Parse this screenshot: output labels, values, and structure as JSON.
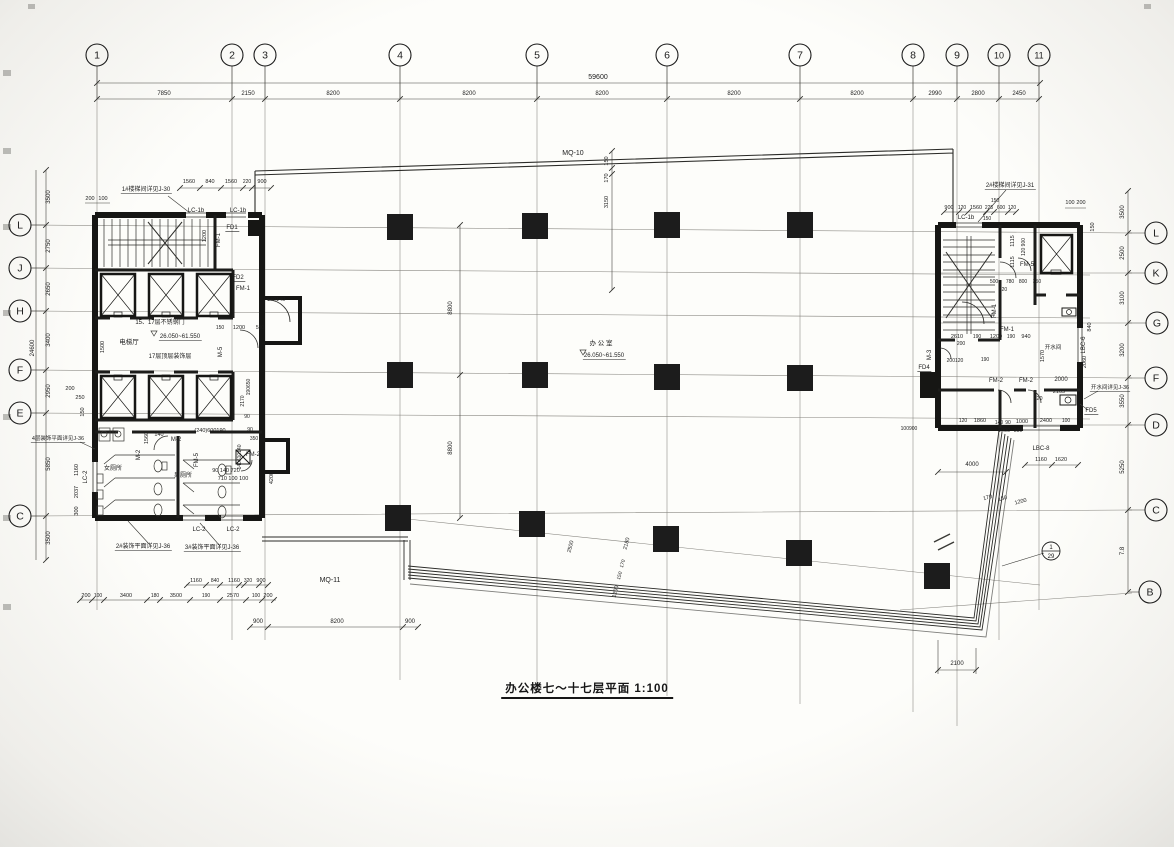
{
  "title": {
    "text": "办公楼七～十七层平面 1:100"
  },
  "colors": {
    "ink": "#1c1c1c",
    "paper": "#f6f6f2",
    "thin": "#6a6a66",
    "dim": "#3a3a38"
  },
  "grid_bubbles": {
    "top": [
      {
        "label": "1",
        "x": 97
      },
      {
        "label": "2",
        "x": 232
      },
      {
        "label": "3",
        "x": 265
      },
      {
        "label": "4",
        "x": 400
      },
      {
        "label": "5",
        "x": 537
      },
      {
        "label": "6",
        "x": 667
      },
      {
        "label": "7",
        "x": 800
      },
      {
        "label": "8",
        "x": 913
      },
      {
        "label": "9",
        "x": 957
      },
      {
        "label": "10",
        "x": 999
      },
      {
        "label": "11",
        "x": 1039
      }
    ],
    "left": [
      {
        "label": "L",
        "y": 225
      },
      {
        "label": "J",
        "y": 268
      },
      {
        "label": "H",
        "y": 311
      },
      {
        "label": "F",
        "y": 370
      },
      {
        "label": "E",
        "y": 413
      },
      {
        "label": "C",
        "y": 516
      }
    ],
    "right": [
      {
        "label": "L",
        "y": 233,
        "x": 1156
      },
      {
        "label": "K",
        "y": 273,
        "x": 1156
      },
      {
        "label": "G",
        "y": 323,
        "x": 1157
      },
      {
        "label": "F",
        "y": 378,
        "x": 1156
      },
      {
        "label": "D",
        "y": 425,
        "x": 1156
      },
      {
        "label": "C",
        "y": 510,
        "x": 1156
      },
      {
        "label": "B",
        "y": 592,
        "x": 1150
      }
    ]
  },
  "detail_bubble": {
    "x": 1051,
    "y": 551,
    "top": "1",
    "bottom": "29"
  },
  "columns": [
    [
      400,
      227
    ],
    [
      535,
      226
    ],
    [
      667,
      225
    ],
    [
      800,
      225
    ],
    [
      400,
      375
    ],
    [
      535,
      375
    ],
    [
      667,
      377
    ],
    [
      800,
      378
    ],
    [
      398,
      518
    ],
    [
      532,
      524
    ],
    [
      666,
      539
    ],
    [
      799,
      553
    ],
    [
      937,
      576
    ]
  ],
  "annotations": [
    [
      "59600",
      598,
      79,
      0,
      7,
      0
    ],
    [
      "7850",
      164,
      95,
      0,
      6,
      0
    ],
    [
      "2150",
      248,
      95,
      0,
      6,
      0
    ],
    [
      "8200",
      333,
      95,
      0,
      6,
      0
    ],
    [
      "8200",
      469,
      95,
      0,
      6,
      0
    ],
    [
      "8200",
      602,
      95,
      0,
      6,
      0
    ],
    [
      "8200",
      734,
      95,
      0,
      6,
      0
    ],
    [
      "8200",
      857,
      95,
      0,
      6,
      0
    ],
    [
      "2990",
      935,
      95,
      0,
      6,
      0
    ],
    [
      "2800",
      978,
      95,
      0,
      6,
      0
    ],
    [
      "2450",
      1019,
      95,
      0,
      6,
      0
    ],
    [
      "MQ-10",
      573,
      155,
      0,
      7,
      0
    ],
    [
      "150",
      608,
      161,
      -90,
      5.5,
      0
    ],
    [
      "170",
      608,
      178,
      -90,
      5.5,
      0
    ],
    [
      "3150",
      608,
      202,
      -90,
      5.5,
      0
    ],
    [
      "3500",
      50,
      197,
      -90,
      6,
      0
    ],
    [
      "2750",
      50,
      246,
      -90,
      6,
      0
    ],
    [
      "2650",
      50,
      289,
      -90,
      6,
      0
    ],
    [
      "3400",
      50,
      340,
      -90,
      6,
      0
    ],
    [
      "2950",
      50,
      391,
      -90,
      6,
      0
    ],
    [
      "5850",
      50,
      464,
      -90,
      6,
      0
    ],
    [
      "3500",
      50,
      538,
      -90,
      6,
      0
    ],
    [
      "24600",
      34,
      348,
      -90,
      6,
      0
    ],
    [
      "3500",
      1124,
      212,
      -90,
      6,
      0
    ],
    [
      "2500",
      1124,
      253,
      -90,
      6,
      0
    ],
    [
      "3100",
      1124,
      298,
      -90,
      6,
      0
    ],
    [
      "3200",
      1124,
      350,
      -90,
      6,
      0
    ],
    [
      "3550",
      1124,
      401,
      -90,
      6,
      0
    ],
    [
      "5250",
      1124,
      467,
      -90,
      6,
      0
    ],
    [
      "7.8",
      1124,
      551,
      -90,
      6,
      0
    ],
    [
      "1#楼梯间详见J-30",
      146,
      191,
      0,
      6,
      1
    ],
    [
      "200",
      90,
      200,
      0,
      5.5,
      0
    ],
    [
      "100",
      103,
      200,
      0,
      5.5,
      0
    ],
    [
      "1560",
      189,
      183,
      0,
      5.5,
      0
    ],
    [
      "840",
      210,
      183,
      0,
      5.5,
      0
    ],
    [
      "1560",
      231,
      183,
      0,
      5.5,
      0
    ],
    [
      "220",
      247,
      183,
      0,
      5,
      0
    ],
    [
      "900",
      262,
      183,
      0,
      5.5,
      0
    ],
    [
      "LC-1b",
      196,
      212,
      0,
      6,
      0
    ],
    [
      "LC-1b",
      238,
      212,
      0,
      6,
      0
    ],
    [
      "FD1",
      232,
      229,
      0,
      6,
      1
    ],
    [
      "1200",
      206,
      236,
      -90,
      5.5,
      0
    ],
    [
      "FM-1",
      220,
      240,
      -90,
      6,
      0
    ],
    [
      "FD2",
      238,
      279,
      0,
      6,
      1
    ],
    [
      "FM-1",
      243,
      290,
      0,
      6,
      0
    ],
    [
      "640140",
      276,
      301,
      0,
      5.5,
      0
    ],
    [
      "15、17层不锈钢门",
      160,
      324,
      0,
      6,
      0
    ],
    [
      "150",
      220,
      329,
      0,
      5,
      0
    ],
    [
      "1200",
      239,
      329,
      0,
      5.5,
      0
    ],
    [
      "550",
      260,
      329,
      0,
      5,
      0
    ],
    [
      "电梯厅",
      129,
      344,
      0,
      6.5,
      0
    ],
    [
      "26.050~61.550",
      180,
      338,
      0,
      6,
      1
    ],
    [
      "17层顶层装饰层",
      170,
      358,
      0,
      6,
      0
    ],
    [
      "M-5",
      222,
      352,
      -90,
      6,
      0
    ],
    [
      "1500",
      104,
      347,
      -90,
      5.5,
      0
    ],
    [
      "190650",
      250,
      387,
      -90,
      5,
      0
    ],
    [
      "2170",
      244,
      401,
      -90,
      5,
      0
    ],
    [
      "90",
      247,
      418,
      0,
      5,
      0
    ],
    [
      "M-2",
      176,
      441,
      0,
      6,
      0
    ],
    [
      "M-2",
      140,
      455,
      -90,
      6,
      0
    ],
    [
      "FM-5",
      198,
      460,
      -90,
      6,
      0
    ],
    [
      "1560",
      148,
      438,
      -90,
      5.5,
      0
    ],
    [
      "140",
      159,
      436,
      0,
      5.5,
      0
    ],
    [
      "(240)600190",
      210,
      432,
      0,
      5.5,
      0
    ],
    [
      "90",
      250,
      431,
      0,
      5,
      0
    ],
    [
      "350",
      254,
      440,
      0,
      5,
      0
    ],
    [
      "FM-2",
      253,
      456,
      0,
      6,
      0
    ],
    [
      "140610140",
      241,
      457,
      -90,
      5,
      0
    ],
    [
      "90 140 720",
      226,
      472,
      0,
      5.5,
      0
    ],
    [
      "710 100 100",
      233,
      480,
      0,
      5.5,
      0
    ],
    [
      "女厕所",
      113,
      470,
      0,
      6,
      0
    ],
    [
      "男厕所",
      183,
      477,
      0,
      6,
      0
    ],
    [
      "4200",
      273,
      478,
      -90,
      5.5,
      0
    ],
    [
      "LC-2",
      87,
      477,
      -90,
      6,
      0
    ],
    [
      "1160",
      78,
      470,
      -90,
      5.5,
      0
    ],
    [
      "2037",
      78,
      492,
      -90,
      5.5,
      0
    ],
    [
      "300",
      78,
      511,
      -90,
      5.5,
      0
    ],
    [
      "200",
      70,
      390,
      0,
      5.5,
      0
    ],
    [
      "250",
      80,
      399,
      0,
      5.5,
      0
    ],
    [
      "150",
      84,
      412,
      -90,
      5.5,
      0
    ],
    [
      "4层装饰平面详见J-36",
      58,
      440,
      0,
      5.5,
      1
    ],
    [
      "LC-2",
      199,
      531,
      0,
      6,
      0
    ],
    [
      "LC-2",
      233,
      531,
      0,
      6,
      0
    ],
    [
      "2#装饰平面详见J-36",
      143,
      548,
      0,
      6,
      1
    ],
    [
      "3#装饰平面详见J-36",
      212,
      549,
      0,
      6,
      1
    ],
    [
      "1160",
      196,
      582,
      0,
      5.5,
      0
    ],
    [
      "840",
      215,
      582,
      0,
      5,
      0
    ],
    [
      "1160",
      234,
      582,
      0,
      5.5,
      0
    ],
    [
      "320",
      248,
      582,
      0,
      5,
      0
    ],
    [
      "900",
      261,
      582,
      0,
      5.5,
      0
    ],
    [
      "200",
      86,
      597,
      0,
      5.5,
      0
    ],
    [
      "100",
      98,
      597,
      0,
      5,
      0
    ],
    [
      "3400",
      126,
      597,
      0,
      5.5,
      0
    ],
    [
      "180",
      155,
      597,
      0,
      5,
      0
    ],
    [
      "3500",
      176,
      597,
      0,
      5.5,
      0
    ],
    [
      "190",
      206,
      597,
      0,
      5,
      0
    ],
    [
      "2570",
      233,
      597,
      0,
      5.5,
      0
    ],
    [
      "100",
      256,
      597,
      0,
      5,
      0
    ],
    [
      "200",
      268,
      597,
      0,
      5.5,
      0
    ],
    [
      "900",
      258,
      623,
      0,
      6,
      0
    ],
    [
      "8200",
      337,
      623,
      0,
      6,
      0
    ],
    [
      "900",
      410,
      623,
      0,
      6,
      0
    ],
    [
      "MQ-11",
      330,
      582,
      0,
      7,
      0
    ],
    [
      "办 公 室",
      601,
      345,
      0,
      6.5,
      0
    ],
    [
      "26.050~61.550",
      604,
      357,
      0,
      6,
      1
    ],
    [
      "8800",
      452,
      308,
      -90,
      6,
      0
    ],
    [
      "8800",
      452,
      448,
      -90,
      6,
      0
    ],
    [
      "2500",
      572,
      547,
      -75,
      5.5,
      0
    ],
    [
      "2180",
      628,
      544,
      -75,
      5.5,
      0
    ],
    [
      "170",
      624,
      564,
      -75,
      5,
      0
    ],
    [
      "150",
      621,
      576,
      -75,
      5,
      0
    ],
    [
      "1200",
      617,
      592,
      -75,
      5.5,
      0
    ],
    [
      "170",
      988,
      499,
      -15,
      5.5,
      0
    ],
    [
      "150",
      1003,
      500,
      -15,
      5.5,
      0
    ],
    [
      "1200",
      1021,
      503,
      -15,
      5.5,
      0
    ],
    [
      "2100",
      957,
      665,
      0,
      6,
      0
    ],
    [
      "2#楼梯间详见J-31",
      1010,
      187,
      0,
      6,
      1
    ],
    [
      "900",
      949,
      209,
      0,
      5.5,
      0
    ],
    [
      "120",
      962,
      209,
      0,
      5,
      0
    ],
    [
      "1560",
      976,
      209,
      0,
      5.5,
      0
    ],
    [
      "225",
      989,
      209,
      0,
      5,
      0
    ],
    [
      "600",
      1001,
      209,
      0,
      5,
      0
    ],
    [
      "120",
      1012,
      209,
      0,
      5,
      0
    ],
    [
      "150",
      995,
      202,
      0,
      5,
      0
    ],
    [
      "LC-1b",
      966,
      219,
      0,
      6,
      0
    ],
    [
      "150",
      987,
      220,
      0,
      5,
      0
    ],
    [
      "100",
      1070,
      204,
      0,
      5.5,
      0
    ],
    [
      "200",
      1081,
      204,
      0,
      5.5,
      0
    ],
    [
      "150",
      1094,
      227,
      -90,
      5.5,
      0
    ],
    [
      "1115",
      1014,
      241,
      -90,
      5.5,
      0
    ],
    [
      "1115",
      1014,
      262,
      -90,
      5.5,
      0
    ],
    [
      "120 900",
      1025,
      247,
      -90,
      5,
      0
    ],
    [
      "FM-5",
      1027,
      266,
      0,
      6,
      0
    ],
    [
      "500",
      994,
      283,
      0,
      5,
      0
    ],
    [
      "780",
      1010,
      283,
      0,
      5,
      0
    ],
    [
      "800",
      1023,
      283,
      0,
      5,
      0
    ],
    [
      "350",
      1037,
      283,
      0,
      5,
      0
    ],
    [
      "120",
      1003,
      291,
      0,
      5,
      0
    ],
    [
      "FM-1",
      996,
      311,
      -90,
      6,
      0
    ],
    [
      "FM-1",
      1007,
      331,
      0,
      6,
      0
    ],
    [
      "2610",
      957,
      338,
      0,
      5.5,
      0
    ],
    [
      "190",
      977,
      338,
      0,
      5,
      0
    ],
    [
      "1200",
      996,
      338,
      0,
      5.5,
      0
    ],
    [
      "190",
      1011,
      338,
      0,
      5,
      0
    ],
    [
      "940",
      1026,
      338,
      0,
      5.5,
      0
    ],
    [
      "200",
      961,
      345,
      0,
      5,
      0
    ],
    [
      "M-3",
      931,
      355,
      -90,
      6,
      0
    ],
    [
      "FD4",
      924,
      369,
      0,
      6,
      1
    ],
    [
      "200120",
      955,
      362,
      0,
      5,
      0
    ],
    [
      "190",
      985,
      361,
      0,
      5,
      0
    ],
    [
      "1570",
      1044,
      356,
      -90,
      5.5,
      0
    ],
    [
      "开水间",
      1053,
      349,
      0,
      5.5,
      0
    ],
    [
      "FM-2",
      996,
      382,
      0,
      6,
      0
    ],
    [
      "FM-2",
      1026,
      382,
      0,
      6,
      0
    ],
    [
      "2000",
      1061,
      381,
      0,
      6,
      0
    ],
    [
      "2105",
      1059,
      393,
      0,
      5.5,
      0
    ],
    [
      "120",
      1038,
      400,
      0,
      5.5,
      0
    ],
    [
      "840",
      1091,
      327,
      -90,
      5.5,
      0
    ],
    [
      "LBC-6",
      1085,
      345,
      -90,
      6,
      0
    ],
    [
      "2060",
      1086,
      362,
      -90,
      5.5,
      0
    ],
    [
      "FD5",
      1091,
      412,
      0,
      6,
      1
    ],
    [
      "开水间详见J-36",
      1110,
      389,
      0,
      5.5,
      1
    ],
    [
      "120",
      963,
      422,
      0,
      5,
      0
    ],
    [
      "1860",
      980,
      422,
      0,
      5.5,
      0
    ],
    [
      "140",
      999,
      424,
      0,
      5,
      0
    ],
    [
      "90",
      1008,
      424,
      0,
      5,
      0
    ],
    [
      "1000",
      1022,
      423,
      0,
      5.5,
      0
    ],
    [
      "2400",
      1046,
      422,
      0,
      5.5,
      0
    ],
    [
      "100",
      1066,
      422,
      0,
      5,
      0
    ],
    [
      "100900",
      909,
      430,
      0,
      5,
      0
    ],
    [
      "1000",
      1004,
      432,
      0,
      5.5,
      0
    ],
    [
      "390",
      1018,
      432,
      0,
      5,
      0
    ],
    [
      "LBC-8",
      1041,
      450,
      0,
      6,
      0
    ],
    [
      "1160",
      1041,
      461,
      0,
      5.5,
      0
    ],
    [
      "1620",
      1061,
      461,
      0,
      5.5,
      0
    ],
    [
      "4000",
      972,
      466,
      0,
      6,
      0
    ]
  ]
}
